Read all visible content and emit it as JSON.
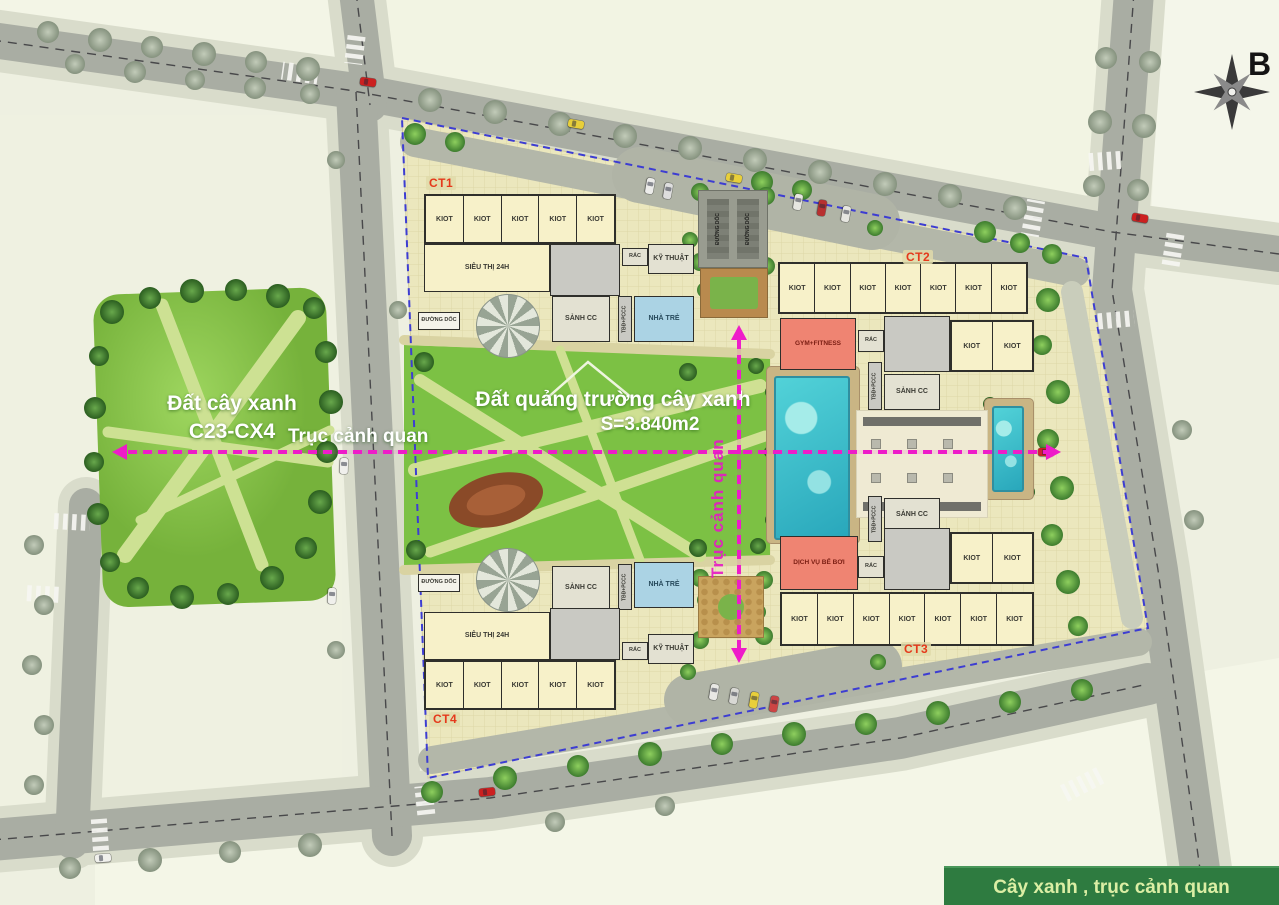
{
  "compass": {
    "label": "B"
  },
  "legend": {
    "label": "Cây xanh , trục cảnh quan"
  },
  "axes": {
    "horizontal_label": "Trục cảnh quan",
    "vertical_label": "Trục cảnh quan"
  },
  "park": {
    "name_line1": "Đất cây xanh",
    "name_line2": "C23-CX4"
  },
  "plaza": {
    "name_line1": "Đất quảng trường cây xanh",
    "area": "S=3.840m2"
  },
  "ramp_area": {
    "labels": [
      "ĐƯỜNG DỐC",
      "ĐƯỜNG DỐC"
    ]
  },
  "buildings": {
    "ct1": {
      "code": "CT1",
      "kiosks": [
        "KIOT",
        "KIOT",
        "KIOT",
        "KIOT",
        "KIOT"
      ],
      "supermarket": "SIÊU THỊ 24H",
      "lobby": "SẢNH CC",
      "kindergarten": "NHÀ TRẺ",
      "trash": "RÁC",
      "technical": "KỸ THUẬT",
      "electrical": "TBĐ+PCCC",
      "ramp": "ĐƯỜNG DỐC"
    },
    "ct2": {
      "code": "CT2",
      "kiosks": [
        "KIOT",
        "KIOT",
        "KIOT",
        "KIOT",
        "KIOT",
        "KIOT",
        "KIOT"
      ],
      "kiosks_lower": [
        "KIOT",
        "KIOT"
      ],
      "gym": "GYM+FITNESS",
      "lobby": "SẢNH CC",
      "trash": "RÁC",
      "electrical": "TBĐ+PCCC"
    },
    "ct3": {
      "code": "CT3",
      "kiosks": [
        "KIOT",
        "KIOT",
        "KIOT",
        "KIOT",
        "KIOT",
        "KIOT",
        "KIOT"
      ],
      "kiosks_upper": [
        "KIOT",
        "KIOT"
      ],
      "pool_service": "DỊCH VỤ BỂ BƠI",
      "lobby": "SẢNH CC",
      "trash": "RÁC",
      "electrical": "TBĐ+PCCC"
    },
    "ct4": {
      "code": "CT4",
      "kiosks": [
        "KIOT",
        "KIOT",
        "KIOT",
        "KIOT",
        "KIOT"
      ],
      "supermarket": "SIÊU THỊ 24H",
      "lobby": "SẢNH CC",
      "kindergarten": "NHÀ TRẺ",
      "trash": "RÁC",
      "technical": "KỸ THUẬT",
      "electrical": "TBĐ+PCCC",
      "ramp": "ĐƯỜNG DỐC"
    }
  },
  "colors": {
    "axis_magenta": "#ee1cc9",
    "boundary_blue": "#3d3dd2",
    "pool_teal": "#3fc6cf",
    "service_pink": "#ef8472",
    "kindergarten_blue": "#abd3e4",
    "legend_green": "#2e7b40",
    "ct_code_red": "#e5391b",
    "road_gray": "#a9ada3",
    "park_green": "#7cc144"
  }
}
